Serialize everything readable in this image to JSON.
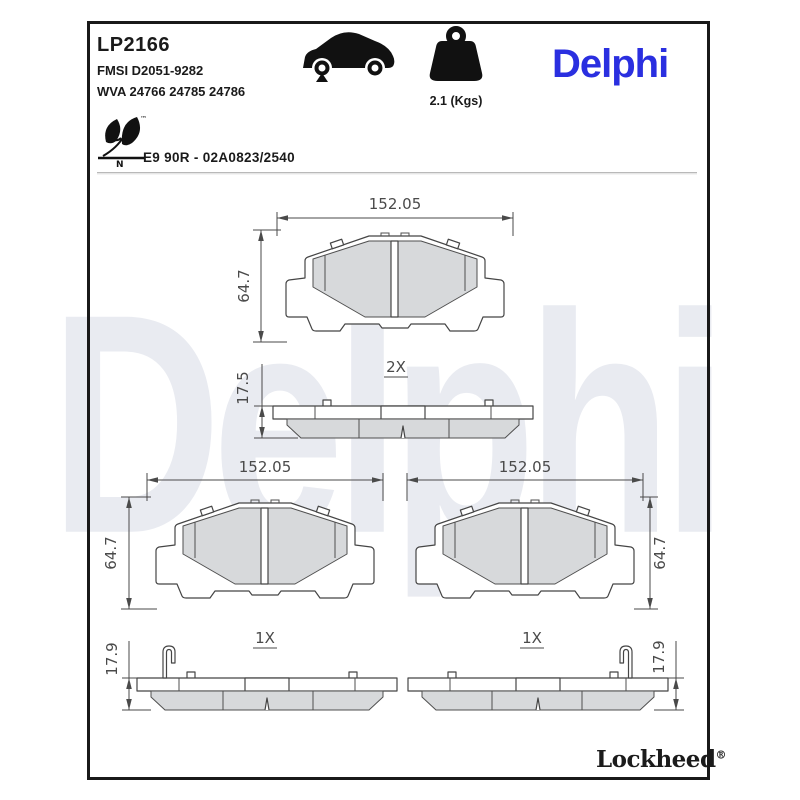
{
  "header": {
    "part_number": "LP2166",
    "fmsi_code": "FMSI D2051-9282",
    "wva_code": "WVA 24766 24785 24786",
    "weight": "2.1 (Kgs)",
    "brand": "Delphi",
    "homologation": "E9 90R - 02A0823/2540",
    "eco_tm": "™",
    "eco_n": "N"
  },
  "drawings": {
    "top_view": {
      "width": "152.05",
      "height": "64.7",
      "quantity": "2X"
    },
    "top_profile": {
      "thickness": "17.5"
    },
    "left_view": {
      "width": "152.05",
      "height": "64.7",
      "quantity": "1X"
    },
    "right_view": {
      "width": "152.05",
      "height": "64.7",
      "quantity": "1X"
    },
    "left_profile": {
      "thickness": "17.9"
    },
    "right_profile": {
      "thickness": "17.9"
    }
  },
  "watermark": "Delphi",
  "footer": {
    "brand": "Lockheed",
    "registered_mark": "®"
  },
  "colors": {
    "brand_blue": "#2a2fe0",
    "watermark": "#e9ebf1",
    "friction": "#d7d9db",
    "line": "#4a4a4a",
    "ink": "#1a1a1a"
  }
}
